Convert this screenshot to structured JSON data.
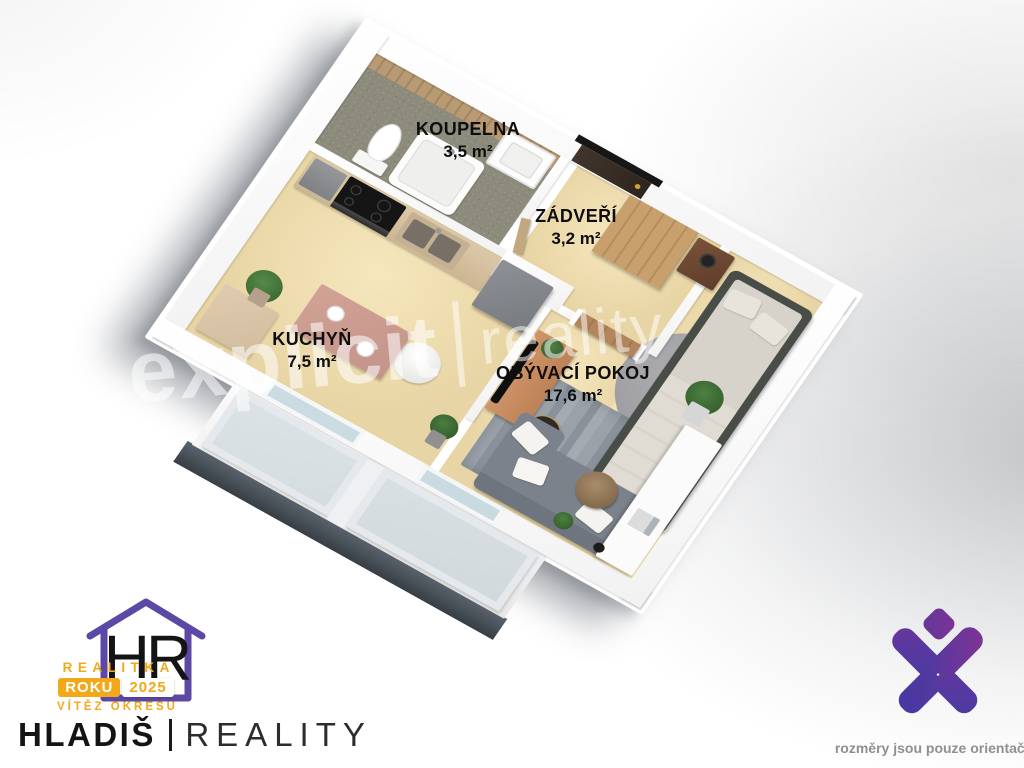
{
  "rooms": [
    {
      "id": "koupelna",
      "name": "KOUPELNA",
      "area": "3,5 m²"
    },
    {
      "id": "zadveri",
      "name": "ZÁDVEŘÍ",
      "area": "3,2 m²"
    },
    {
      "id": "kuchyn",
      "name": "KUCHYŇ",
      "area": "7,5 m²"
    },
    {
      "id": "obyvaci-pokoj",
      "name": "OBÝVACÍ POKOJ",
      "area": "17,6 m²"
    }
  ],
  "watermark": {
    "word1": "explicit",
    "word2": "reality"
  },
  "branding": {
    "award": {
      "line1": "REALITKA",
      "badge_left": "ROKU",
      "badge_right": "2025",
      "line3": "VÍTĚZ OKRESU",
      "monogram": "HR"
    },
    "company": {
      "name": "HLADIŠ",
      "suffix": "REALITY"
    },
    "disclaimer": "rozměry jsou pouze orientační"
  },
  "icons": {
    "award_house": "house-outline-icon",
    "agency_mark": "purple-x-logo-icon"
  },
  "palette": {
    "floor_beige": "#ecd9ab",
    "floor_tile": "#8d8b7c",
    "wall_white": "#ffffff",
    "rug_gray": "#99a0a8",
    "sofa_gray": "#7b828b",
    "bed_frame": "#494d47",
    "wood": "#c49b6a",
    "accent_orange": "#f2a818",
    "accent_purple": "#5b49a5",
    "logo_gradient_start": "#8c3190",
    "logo_gradient_end": "#4438a0",
    "slab_dark": "#4a525b"
  }
}
